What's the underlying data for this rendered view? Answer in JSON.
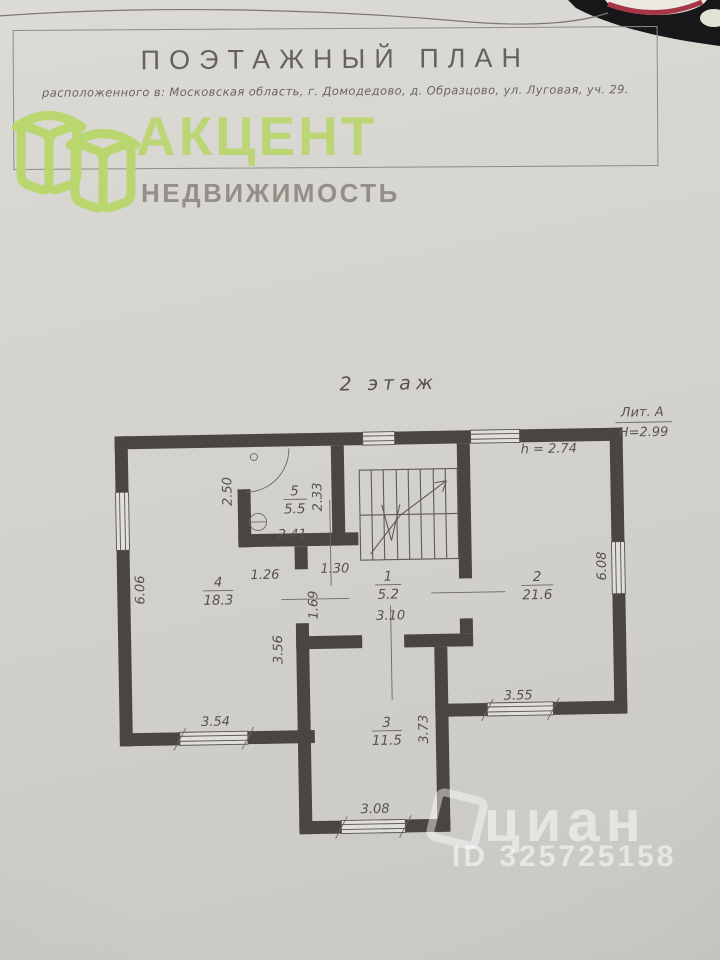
{
  "header": {
    "title": "ПОЭТАЖНЫЙ ПЛАН",
    "subtitle": "расположенного в:  Московская область, г. Домодедово, д. Образцово, ул. Луговая, уч. 29."
  },
  "logo": {
    "name": "АКЦЕНТ",
    "tagline": "НЕДВИЖИМОСТЬ",
    "brand_color": "#bad66f",
    "tagline_color": "#8d8a82"
  },
  "floor_plan": {
    "floor_label": "2 этаж",
    "litera": "Лит. А",
    "building_height": "Н=2.99",
    "ceiling_height": "h = 2.74",
    "rooms": [
      {
        "number": "1",
        "area": "5.2"
      },
      {
        "number": "2",
        "area": "21.6"
      },
      {
        "number": "3",
        "area": "11.5"
      },
      {
        "number": "4",
        "area": "18.3"
      },
      {
        "number": "5",
        "area": "5.5"
      }
    ],
    "dimensions": [
      "2.50",
      "2.33",
      "2.41",
      "1.26",
      "1.30",
      "1.69",
      "6.06",
      "6.08",
      "3.56",
      "3.10",
      "3.73",
      "3.54",
      "3.55",
      "3.08"
    ]
  },
  "watermark": {
    "site": "циан",
    "listing_id": "ID 325725158"
  },
  "colors": {
    "wall": "#4a4540",
    "paper": "#d5d3ce",
    "pencil": "#56524b"
  }
}
